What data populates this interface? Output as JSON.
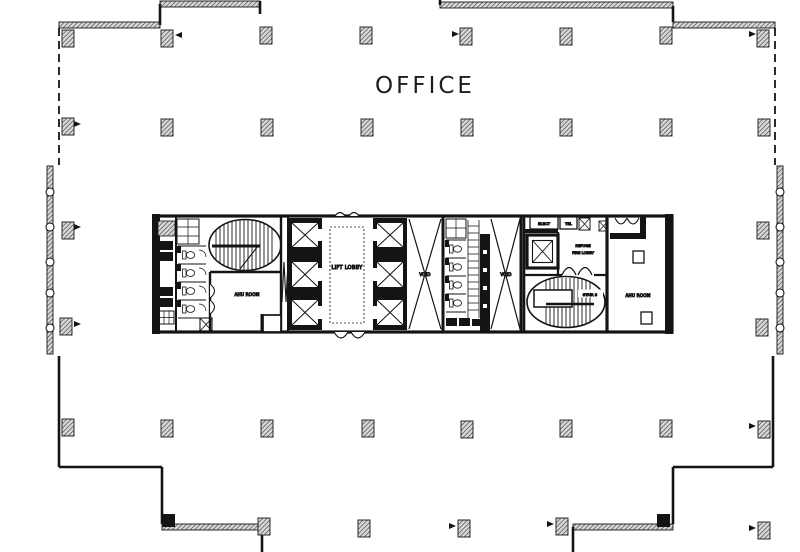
{
  "colors": {
    "ink": "#1d1d1d",
    "paper": "#ffffff",
    "column_fill": "#d8d8d8"
  },
  "plan": {
    "office_label": "OFFICE",
    "labels": {
      "lift_lobby": "LIFT LOBBY",
      "ahu_room_left": "AHU ROOM",
      "ahu_room_right": "AHU ROOM",
      "void_left": "VOID",
      "void_right": "VOID",
      "elect": "ELECT",
      "tel": "TEL",
      "refuge_line1": "REFUGE",
      "refuge_line2": "FIRE LOBBY",
      "stair_3": "STAIR 3"
    }
  }
}
